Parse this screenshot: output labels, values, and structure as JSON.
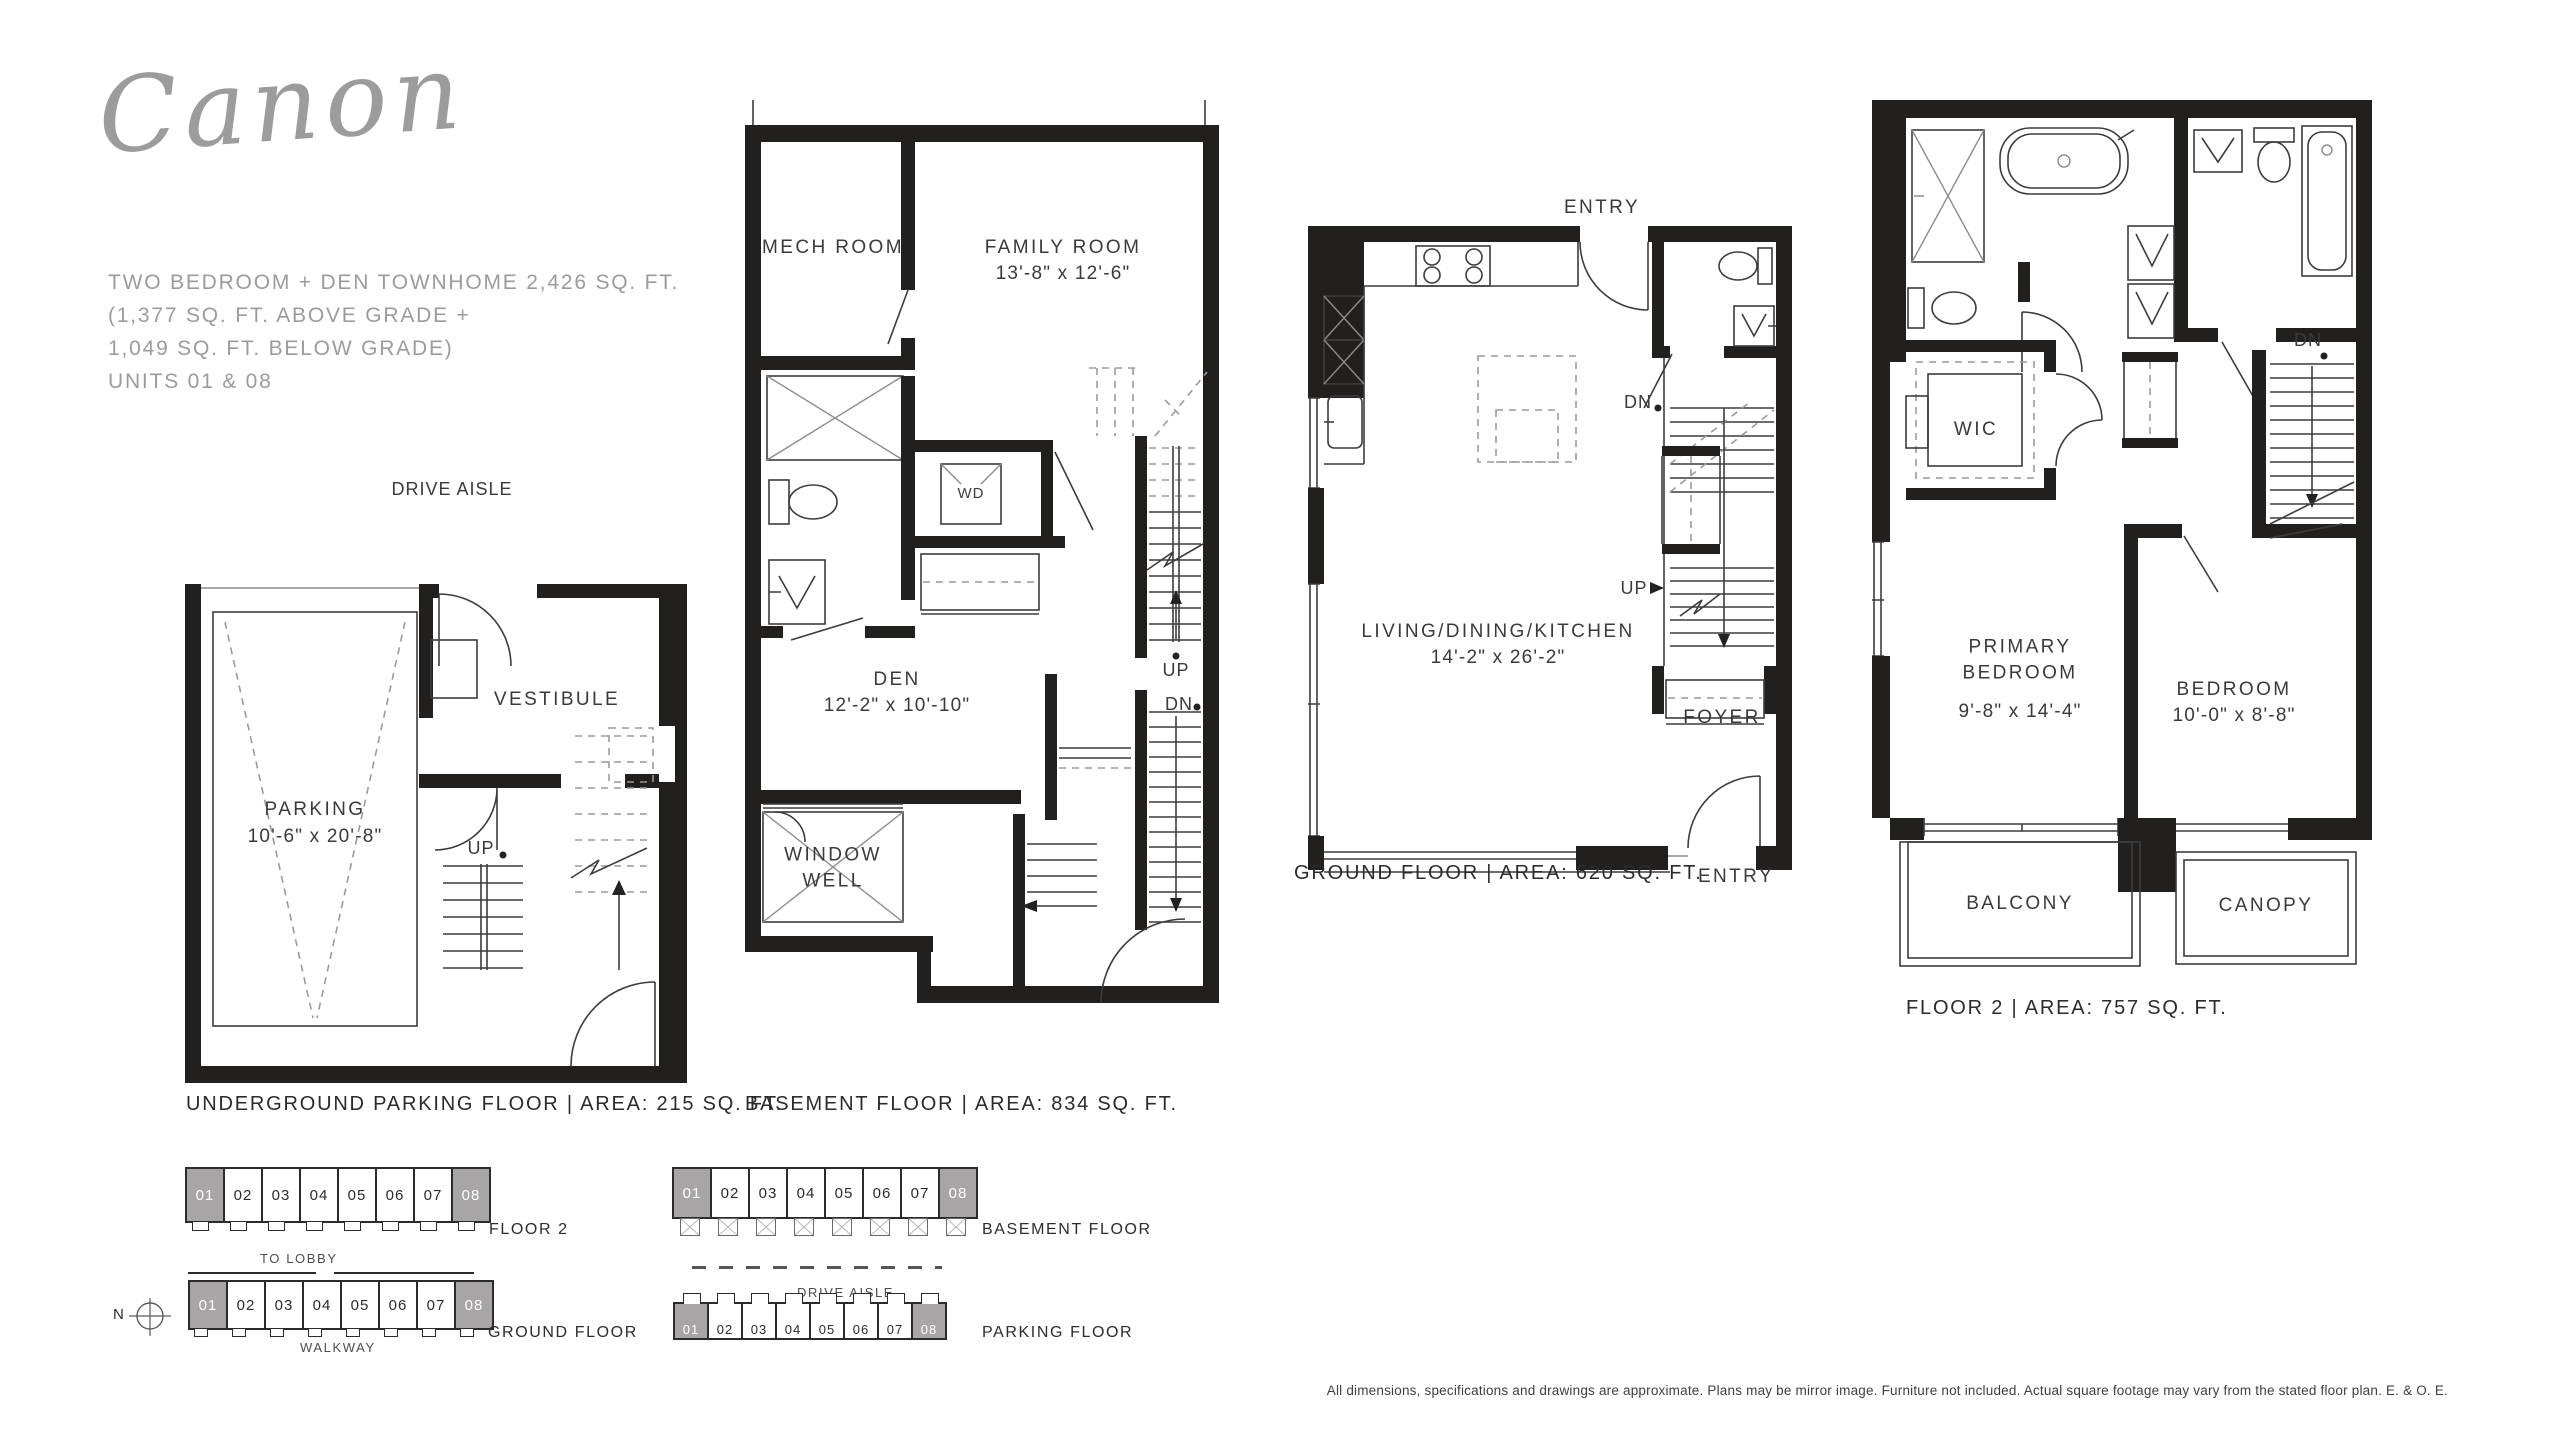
{
  "brand": {
    "logo_text": "Canon"
  },
  "summary": {
    "lines": [
      "TWO BEDROOM + DEN TOWNHOME  2,426 SQ. FT.",
      "(1,377 SQ. FT. ABOVE GRADE +",
      "1,049 SQ. FT. BELOW GRADE)",
      "UNITS 01 & 08"
    ]
  },
  "plans": {
    "parking": {
      "drive_aisle": "DRIVE AISLE",
      "parking_room": "PARKING",
      "parking_dims": "10'-6\" x 20'-8\"",
      "vestibule": "VESTIBULE",
      "up": "UP",
      "caption": "UNDERGROUND PARKING FLOOR  |  AREA: 215 SQ. FT."
    },
    "basement": {
      "mech_room": "MECH ROOM",
      "family_room": "FAMILY ROOM",
      "family_dims": "13'-8\" x 12'-6\"",
      "wd": "WD",
      "den": "DEN",
      "den_dims": "12'-2\" x 10'-10\"",
      "window_well": "WINDOW WELL",
      "up": "UP",
      "dn": "DN",
      "caption": "BASEMENT FLOOR  |  AREA: 834 SQ. FT."
    },
    "ground": {
      "entry_top": "ENTRY",
      "living": "LIVING/DINING/KITCHEN",
      "living_dims": "14'-2\" x 26'-2\"",
      "dn": "DN",
      "up": "UP",
      "foyer": "FOYER",
      "entry_bottom": "ENTRY",
      "caption": "GROUND FLOOR  |  AREA: 620 SQ. FT."
    },
    "floor2": {
      "wic": "WIC",
      "dn": "DN",
      "primary_bedroom": "PRIMARY BEDROOM",
      "primary_dims": "9'-8\" x 14'-4\"",
      "bedroom": "BEDROOM",
      "bedroom_dims": "10'-0\" x 8'-8\"",
      "balcony": "BALCONY",
      "canopy": "CANOPY",
      "caption": "FLOOR 2  |  AREA: 757 SQ. FT."
    }
  },
  "keyplans": {
    "units": [
      "01",
      "02",
      "03",
      "04",
      "05",
      "06",
      "07",
      "08"
    ],
    "highlighted_units": [
      "01",
      "08"
    ],
    "floor2_label": "FLOOR 2",
    "to_lobby": "TO LOBBY",
    "ground_label": "GROUND FLOOR",
    "walkway": "WALKWAY",
    "basement_label": "BASEMENT FLOOR",
    "drive_aisle": "DRIVE AISLE",
    "parking_label": "PARKING FLOOR",
    "north": "N"
  },
  "disclaimer": "All dimensions, specifications and drawings are approximate. Plans may be mirror image. Furniture not included. Actual square footage may vary from the stated floor plan. E. & O. E.",
  "colors": {
    "wall": "#221f1f",
    "thin_line": "#3c3c3c",
    "muted_gray": "#9b9b9b",
    "unit_highlight": "#a7a5a6"
  }
}
